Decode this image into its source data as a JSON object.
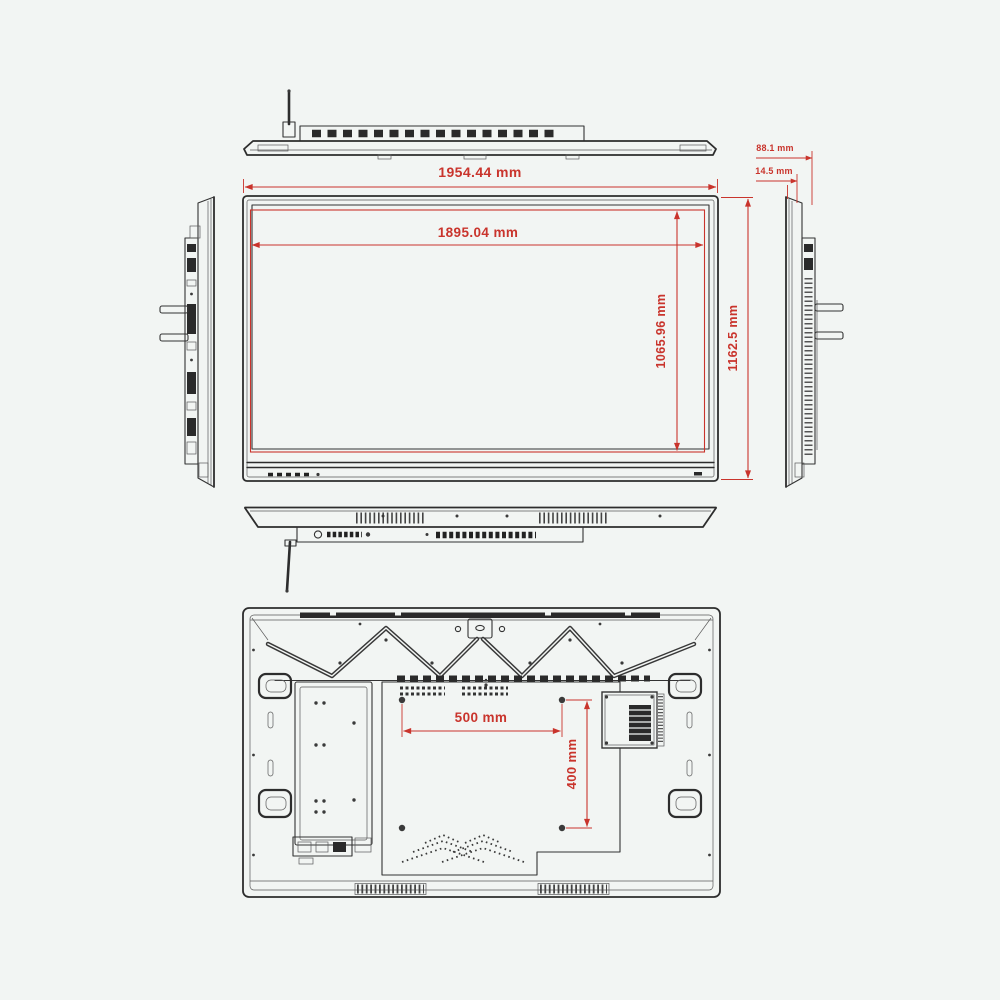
{
  "drawing": {
    "type": "interactive-flat-panel-dimension-drawing",
    "background_color": "#f2f5f3",
    "line_color": "#2d2d2d",
    "dimension_color": "#c9342c"
  },
  "dimensions": {
    "overall_width": "1954.44 mm",
    "active_area_width": "1895.04 mm",
    "active_area_height": "1065.96 mm",
    "overall_height": "1162.5 mm",
    "depth_overall": "88.1 mm",
    "depth_front": "14.5 mm",
    "vesa_horizontal": "500 mm",
    "vesa_vertical": "400 mm"
  }
}
